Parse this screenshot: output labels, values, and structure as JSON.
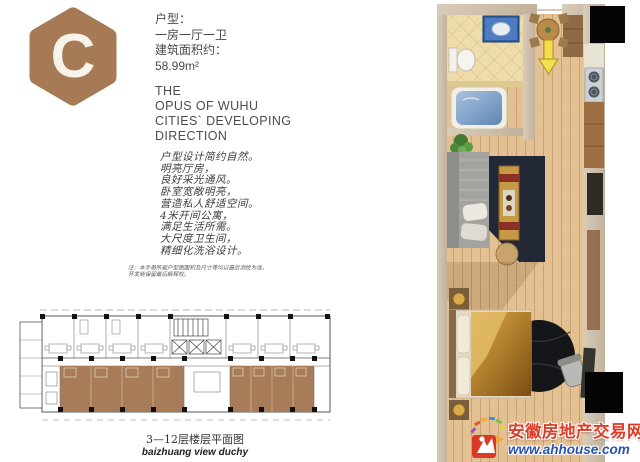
{
  "badge": {
    "letter": "C"
  },
  "unit_info": {
    "type_label": "户型：",
    "type_value": "一房一厅一卫",
    "area_label": "建筑面积约：",
    "area_value": "58.99m²"
  },
  "english_title": {
    "lines": [
      "THE",
      "OPUS OF WUHU",
      "CITIES` DEVELOPING",
      "DIRECTION"
    ]
  },
  "description": {
    "lines": [
      "户型设计简约自然。",
      "明亮厅房，",
      "良好采光通风。",
      "卧室宽敞明亮，",
      "营造私人舒适空间。",
      "4米开间公寓，",
      "满足生活所需。",
      "大尺度卫生间，",
      "精细化洗浴设计。"
    ]
  },
  "note": {
    "lines": [
      "注：本手册所载户型图面积及尺寸等均以最后测绘为准，",
      "开发商保留最后解释权。"
    ]
  },
  "floorplan_caption": {
    "cn": "3—12层楼层平面图",
    "en": "baizhuang view duchy"
  },
  "watermark": {
    "site_name": "安徽房地产交易网",
    "url": "www.ahhouse.com"
  },
  "colors": {
    "accent_brown": "#a57a54",
    "unit_highlight": "#a87c58",
    "watermark_red": "#dd3b25",
    "watermark_blue": "#2a52b0",
    "entrance_arrow_yellow": "#f3df4e"
  },
  "icons": {
    "badge_hexagon": "hexagon-badge-icon",
    "entrance_arrow": "entrance-arrow-icon"
  }
}
